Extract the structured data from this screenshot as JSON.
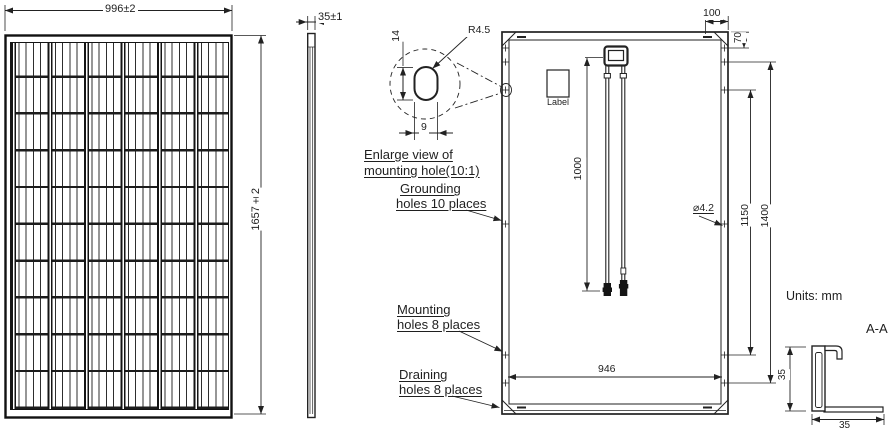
{
  "drawing": {
    "units_note": "Units: mm",
    "section_label": "A-A"
  },
  "front_view": {
    "width_dim": "996±2",
    "height_dim": "1657±2"
  },
  "side_view": {
    "thickness_dim": "35±1"
  },
  "enlarged_view": {
    "caption_line1": "Enlarge view of",
    "caption_line2": "mounting hole(10:1)",
    "slot_length_dim": "14",
    "corner_radius_dim": "R4.5",
    "slot_width_dim": "9"
  },
  "callouts": {
    "grounding_line1": "Grounding",
    "grounding_line2": "holes 10 places",
    "mounting_line1": "Mounting",
    "mounting_line2": "holes 8 places",
    "draining_line1": "Draining",
    "draining_line2": "holes 8 places"
  },
  "back_view": {
    "junction_label": "Label",
    "cable_length_dim": "1000",
    "corner_hole_offset_dim": "100",
    "edge_hole_offset_dim": "70",
    "hole_diameter_dim": "⌀4.2",
    "inner_hole_spacing_dim": "1150",
    "outer_hole_spacing_dim": "1400",
    "width_hole_spacing_dim": "946"
  },
  "section_view": {
    "height_dim": "35",
    "width_dim": "35"
  },
  "colors": {
    "line": "#222222",
    "background": "#ffffff"
  }
}
